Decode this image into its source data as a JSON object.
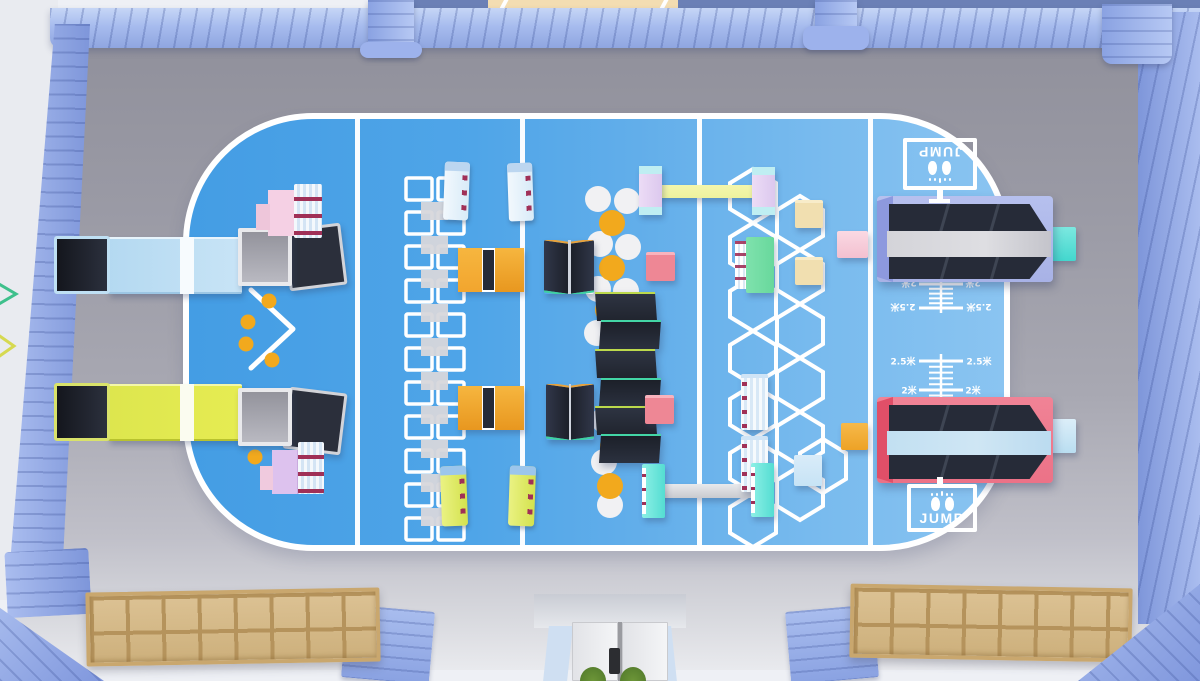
{
  "colors": {
    "wall_blue": "#8fa6e0",
    "wall_dark": "#6b80b6",
    "skylight_beige": "#f3ddb2",
    "floor_gray": "#9b9ba5",
    "floor_light": "#e9eaef",
    "court_blue": "#449de4",
    "court_blue_right": "#8ac4f1",
    "line_white": "#ffffff",
    "ramp_blue": "#c8e4f6",
    "ramp_yellow": "#e6ec52",
    "mat_navy": "#262b38",
    "mat_orange": "#f2a52e",
    "mat_pink": "#ee8795",
    "dot_orange": "#f2a91d",
    "dot_white": "#f1f1f3",
    "shelf_pink": "#f5d0e4",
    "stripe_maroon": "#a03057",
    "beam_yellow": "#eef29e",
    "post_lavender": "#ecdcf6",
    "post_teal": "#54ddd2",
    "bench_green": "#68d89c",
    "mat_tan": "#f1dfb0",
    "mat_lightblue": "#c7e3f5",
    "tramp_frame_top": "#a8b2e6",
    "tramp_frame_bottom": "#ec7287",
    "tramp_lane_gray": "#dedee2",
    "tramp_lane_blue": "#cfe6f4",
    "springboard_teal": "#43d7ce",
    "springboard_blue": "#badef1",
    "wood": "#dcc294",
    "door_white": "#f0f1f3",
    "plant_green": "#4f772a"
  },
  "jump_station": {
    "sign_top": {
      "label": "JUMP",
      "icon": "feet-icon"
    },
    "sign_bottom": {
      "label": "JUMP",
      "icon": "feet-icon"
    },
    "ruler_top": {
      "mark_near": "2米",
      "mark_far": "2.5米"
    },
    "ruler_bottom": {
      "mark_near": "2.5米",
      "mark_far": "2米"
    }
  }
}
